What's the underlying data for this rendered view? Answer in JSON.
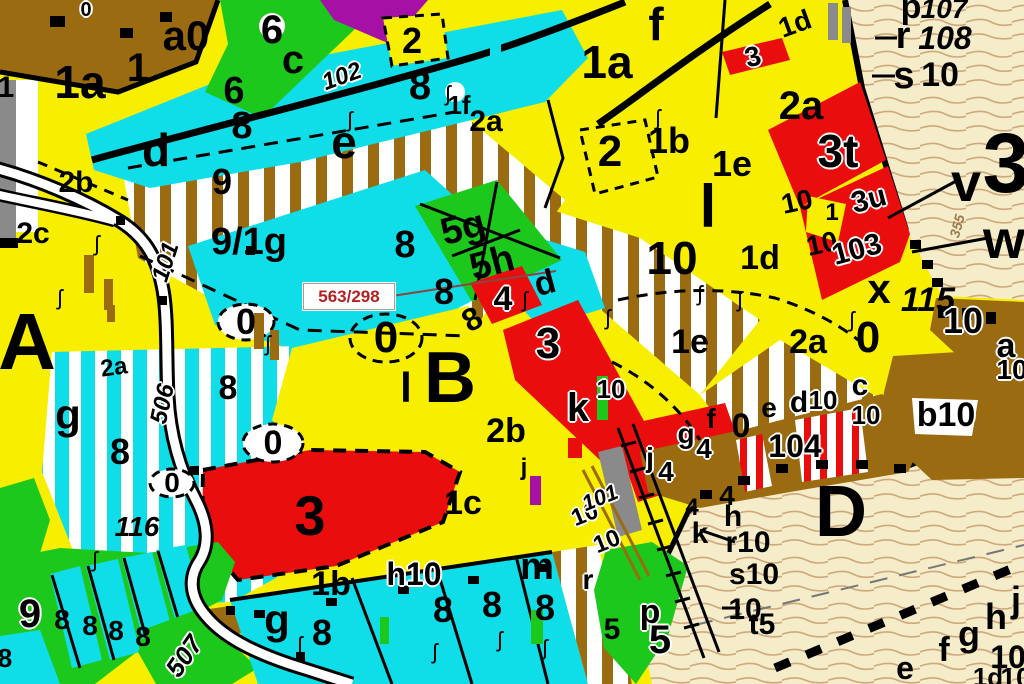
{
  "map": {
    "type": "forest-stand-cadastral-map",
    "annotation": {
      "text": "563/298",
      "color": "#b22222",
      "x": 303,
      "y": 283,
      "w": 90,
      "h": 25
    },
    "palette": {
      "yellow": "#f7ee00",
      "cyan": "#0fdde8",
      "green": "#1cc81c",
      "red": "#ea0d0d",
      "purple": "#a511a5",
      "brown": "#9a6b11",
      "beige": "#f5ecc9",
      "contour": "#cfa87c",
      "gray": "#8a8a8a",
      "white": "#ffffff",
      "black": "#000000",
      "road": "#ffffff",
      "annotation_red": "#b22222"
    },
    "labels": [
      {
        "t": "1a",
        "x": 80,
        "y": 82,
        "s": 46
      },
      {
        "t": "1",
        "x": 138,
        "y": 68,
        "s": 40
      },
      {
        "t": "a0",
        "x": 186,
        "y": 36,
        "s": 42
      },
      {
        "t": "0",
        "x": 86,
        "y": 10,
        "s": 20,
        "h": 1
      },
      {
        "t": "1",
        "x": 6,
        "y": 88,
        "s": 30
      },
      {
        "t": "6",
        "x": 272,
        "y": 30,
        "s": 40
      },
      {
        "t": "c",
        "x": 293,
        "y": 60,
        "s": 40
      },
      {
        "t": "6",
        "x": 234,
        "y": 91,
        "s": 38
      },
      {
        "t": "8",
        "x": 242,
        "y": 126,
        "s": 38
      },
      {
        "t": "d",
        "x": 156,
        "y": 150,
        "s": 46
      },
      {
        "t": "e",
        "x": 344,
        "y": 142,
        "s": 46
      },
      {
        "t": "102",
        "x": 342,
        "y": 77,
        "s": 24,
        "i": 1,
        "r": -20,
        "h": 1
      },
      {
        "t": "2",
        "x": 412,
        "y": 41,
        "s": 36
      },
      {
        "t": "8",
        "x": 420,
        "y": 86,
        "s": 40
      },
      {
        "t": "1f",
        "x": 459,
        "y": 105,
        "s": 26
      },
      {
        "t": "2a",
        "x": 486,
        "y": 122,
        "s": 30
      },
      {
        "t": "2b",
        "x": 76,
        "y": 183,
        "s": 30
      },
      {
        "t": "2c",
        "x": 33,
        "y": 234,
        "s": 30
      },
      {
        "t": "9",
        "x": 222,
        "y": 182,
        "s": 36
      },
      {
        "t": "9/1g",
        "x": 249,
        "y": 242,
        "s": 38
      },
      {
        "t": "101",
        "x": 166,
        "y": 262,
        "s": 24,
        "i": 1,
        "r": -72,
        "h": 1
      },
      {
        "t": "1a",
        "x": 607,
        "y": 62,
        "s": 46
      },
      {
        "t": "f",
        "x": 656,
        "y": 24,
        "s": 46
      },
      {
        "t": "2",
        "x": 610,
        "y": 152,
        "s": 44
      },
      {
        "t": "1b",
        "x": 669,
        "y": 141,
        "s": 36
      },
      {
        "t": "1e",
        "x": 732,
        "y": 164,
        "s": 36
      },
      {
        "t": "l",
        "x": 708,
        "y": 207,
        "s": 60
      },
      {
        "t": "1d",
        "x": 795,
        "y": 24,
        "s": 28,
        "r": -20
      },
      {
        "t": "3",
        "x": 753,
        "y": 57,
        "s": 28,
        "r": -15,
        "h": 1
      },
      {
        "t": "2a",
        "x": 801,
        "y": 106,
        "s": 40
      },
      {
        "t": "10",
        "x": 797,
        "y": 202,
        "s": 28,
        "r": -12
      },
      {
        "t": "10",
        "x": 822,
        "y": 244,
        "s": 28,
        "r": -12
      },
      {
        "t": "p",
        "x": 911,
        "y": 7,
        "s": 34
      },
      {
        "t": "107",
        "x": 944,
        "y": 9,
        "s": 28,
        "i": 1
      },
      {
        "t": "r",
        "x": 903,
        "y": 36,
        "s": 38
      },
      {
        "t": "108",
        "x": 945,
        "y": 38,
        "s": 32,
        "i": 1
      },
      {
        "t": "s",
        "x": 904,
        "y": 76,
        "s": 38
      },
      {
        "t": "10",
        "x": 940,
        "y": 75,
        "s": 34
      },
      {
        "t": "3t",
        "x": 838,
        "y": 151,
        "s": 46,
        "h": 1
      },
      {
        "t": "3u",
        "x": 869,
        "y": 200,
        "s": 30,
        "r": -15,
        "h": 1
      },
      {
        "t": "103",
        "x": 857,
        "y": 250,
        "s": 30,
        "r": -15,
        "h": 1
      },
      {
        "t": "1",
        "x": 832,
        "y": 213,
        "s": 24
      },
      {
        "t": "v",
        "x": 966,
        "y": 183,
        "s": 54
      },
      {
        "t": "3",
        "x": 1006,
        "y": 163,
        "s": 84
      },
      {
        "t": "w",
        "x": 1004,
        "y": 240,
        "s": 54
      },
      {
        "t": "x",
        "x": 879,
        "y": 289,
        "s": 42
      },
      {
        "t": "115",
        "x": 928,
        "y": 300,
        "s": 34,
        "i": 1
      },
      {
        "t": "355",
        "x": 957,
        "y": 226,
        "s": 14,
        "i": 1,
        "r": -75,
        "c": "#9b7d52"
      },
      {
        "t": "10",
        "x": 672,
        "y": 258,
        "s": 46
      },
      {
        "t": "1d",
        "x": 760,
        "y": 258,
        "s": 34
      },
      {
        "t": "1e",
        "x": 690,
        "y": 342,
        "s": 34
      },
      {
        "t": "2a",
        "x": 808,
        "y": 342,
        "s": 34
      },
      {
        "t": "k",
        "x": 578,
        "y": 408,
        "s": 40,
        "h": 1
      },
      {
        "t": "10",
        "x": 611,
        "y": 389,
        "s": 26,
        "h": 1
      },
      {
        "t": "0",
        "x": 246,
        "y": 322,
        "s": 36
      },
      {
        "t": "0",
        "x": 386,
        "y": 338,
        "s": 44
      },
      {
        "t": "8",
        "x": 405,
        "y": 245,
        "s": 38
      },
      {
        "t": "8",
        "x": 444,
        "y": 292,
        "s": 36
      },
      {
        "t": "8",
        "x": 472,
        "y": 319,
        "s": 32,
        "r": -30
      },
      {
        "t": "5g",
        "x": 463,
        "y": 228,
        "s": 38,
        "r": -15
      },
      {
        "t": "5h",
        "x": 492,
        "y": 263,
        "s": 38,
        "r": -15
      },
      {
        "t": "d",
        "x": 545,
        "y": 283,
        "s": 34,
        "r": -15
      },
      {
        "t": "4",
        "x": 503,
        "y": 299,
        "s": 34,
        "h": 1
      },
      {
        "t": "3",
        "x": 548,
        "y": 344,
        "s": 44,
        "h": 1
      },
      {
        "t": "B",
        "x": 450,
        "y": 378,
        "s": 72
      },
      {
        "t": "l",
        "x": 406,
        "y": 388,
        "s": 42
      },
      {
        "t": "2b",
        "x": 506,
        "y": 431,
        "s": 34
      },
      {
        "t": "j",
        "x": 524,
        "y": 468,
        "s": 24
      },
      {
        "t": "A",
        "x": 27,
        "y": 342,
        "s": 80
      },
      {
        "t": "g",
        "x": 68,
        "y": 415,
        "s": 42
      },
      {
        "t": "8",
        "x": 120,
        "y": 452,
        "s": 36
      },
      {
        "t": "2a",
        "x": 114,
        "y": 368,
        "s": 24,
        "r": -8
      },
      {
        "t": "8",
        "x": 228,
        "y": 388,
        "s": 34
      },
      {
        "t": "0",
        "x": 273,
        "y": 443,
        "s": 34
      },
      {
        "t": "0",
        "x": 172,
        "y": 483,
        "s": 28
      },
      {
        "t": "116",
        "x": 137,
        "y": 527,
        "s": 28,
        "i": 1
      },
      {
        "t": "506",
        "x": 163,
        "y": 404,
        "s": 24,
        "i": 1,
        "r": -78,
        "h": 1
      },
      {
        "t": "3",
        "x": 310,
        "y": 516,
        "s": 56
      },
      {
        "t": "1b",
        "x": 331,
        "y": 584,
        "s": 34
      },
      {
        "t": "1c",
        "x": 463,
        "y": 503,
        "s": 34
      },
      {
        "t": "h10",
        "x": 414,
        "y": 574,
        "s": 32,
        "h": 1
      },
      {
        "t": "9",
        "x": 30,
        "y": 614,
        "s": 40,
        "h": 1
      },
      {
        "t": "8",
        "x": 62,
        "y": 620,
        "s": 28
      },
      {
        "t": "8",
        "x": 90,
        "y": 626,
        "s": 28
      },
      {
        "t": "8",
        "x": 116,
        "y": 631,
        "s": 28
      },
      {
        "t": "8",
        "x": 143,
        "y": 637,
        "s": 28
      },
      {
        "t": "507",
        "x": 184,
        "y": 656,
        "s": 26,
        "i": 1,
        "r": -55,
        "h": 1
      },
      {
        "t": "8",
        "x": 5,
        "y": 658,
        "s": 26
      },
      {
        "t": "g",
        "x": 277,
        "y": 620,
        "s": 42
      },
      {
        "t": "8",
        "x": 322,
        "y": 633,
        "s": 36
      },
      {
        "t": "8",
        "x": 443,
        "y": 610,
        "s": 36
      },
      {
        "t": "8",
        "x": 492,
        "y": 605,
        "s": 36
      },
      {
        "t": "8",
        "x": 545,
        "y": 608,
        "s": 36
      },
      {
        "t": "m",
        "x": 537,
        "y": 567,
        "s": 38
      },
      {
        "t": "r",
        "x": 588,
        "y": 580,
        "s": 28,
        "h": 1
      },
      {
        "t": "p",
        "x": 650,
        "y": 612,
        "s": 34,
        "h": 1
      },
      {
        "t": "5",
        "x": 612,
        "y": 630,
        "s": 30
      },
      {
        "t": "5",
        "x": 660,
        "y": 640,
        "s": 40,
        "h": 1
      },
      {
        "t": "j",
        "x": 650,
        "y": 458,
        "s": 28,
        "h": 1
      },
      {
        "t": "4",
        "x": 666,
        "y": 472,
        "s": 28,
        "h": 1
      },
      {
        "t": "g",
        "x": 686,
        "y": 434,
        "s": 28,
        "h": 1
      },
      {
        "t": "4",
        "x": 704,
        "y": 449,
        "s": 28,
        "h": 1
      },
      {
        "t": "f",
        "x": 711,
        "y": 419,
        "s": 28
      },
      {
        "t": "0",
        "x": 741,
        "y": 426,
        "s": 34
      },
      {
        "t": "e",
        "x": 769,
        "y": 408,
        "s": 28
      },
      {
        "t": "d",
        "x": 799,
        "y": 403,
        "s": 30,
        "h": 1
      },
      {
        "t": "10",
        "x": 823,
        "y": 400,
        "s": 26,
        "h": 1
      },
      {
        "t": "c",
        "x": 860,
        "y": 386,
        "s": 30,
        "h": 1
      },
      {
        "t": "10",
        "x": 866,
        "y": 415,
        "s": 26,
        "h": 1
      },
      {
        "t": "104",
        "x": 795,
        "y": 446,
        "s": 32,
        "h": 1
      },
      {
        "t": "4",
        "x": 692,
        "y": 508,
        "s": 24
      },
      {
        "t": "k",
        "x": 700,
        "y": 534,
        "s": 30
      },
      {
        "t": "4",
        "x": 727,
        "y": 496,
        "s": 28
      },
      {
        "t": "h",
        "x": 733,
        "y": 517,
        "s": 30
      },
      {
        "t": "r10",
        "x": 748,
        "y": 543,
        "s": 30
      },
      {
        "t": "s10",
        "x": 754,
        "y": 575,
        "s": 30
      },
      {
        "t": "10",
        "x": 745,
        "y": 610,
        "s": 30
      },
      {
        "t": "t5",
        "x": 762,
        "y": 625,
        "s": 30
      },
      {
        "t": "D",
        "x": 841,
        "y": 512,
        "s": 72
      },
      {
        "t": "b10",
        "x": 946,
        "y": 415,
        "s": 34,
        "h": 1
      },
      {
        "t": "0",
        "x": 868,
        "y": 338,
        "s": 44
      },
      {
        "t": "10",
        "x": 963,
        "y": 321,
        "s": 36,
        "h": 1
      },
      {
        "t": "a",
        "x": 1006,
        "y": 346,
        "s": 34,
        "h": 1
      },
      {
        "t": "10",
        "x": 1012,
        "y": 370,
        "s": 28,
        "h": 1
      },
      {
        "t": "10",
        "x": 585,
        "y": 515,
        "s": 24,
        "r": -22,
        "h": 1
      },
      {
        "t": "10",
        "x": 607,
        "y": 542,
        "s": 24,
        "r": -22,
        "h": 1
      },
      {
        "t": "101",
        "x": 600,
        "y": 498,
        "s": 22,
        "i": 1,
        "r": -22,
        "h": 1
      },
      {
        "t": "e",
        "x": 905,
        "y": 668,
        "s": 32
      },
      {
        "t": "f",
        "x": 944,
        "y": 650,
        "s": 34
      },
      {
        "t": "g",
        "x": 969,
        "y": 634,
        "s": 36
      },
      {
        "t": "h",
        "x": 996,
        "y": 617,
        "s": 36
      },
      {
        "t": "j",
        "x": 1016,
        "y": 600,
        "s": 36
      },
      {
        "t": "10",
        "x": 1008,
        "y": 657,
        "s": 32
      },
      {
        "t": "1d",
        "x": 988,
        "y": 677,
        "s": 26
      },
      {
        "t": "10",
        "x": 1016,
        "y": 678,
        "s": 28
      }
    ],
    "symbols": [
      {
        "x": 97,
        "y": 244
      },
      {
        "x": 60,
        "y": 298
      },
      {
        "x": 350,
        "y": 120
      },
      {
        "x": 448,
        "y": 94
      },
      {
        "x": 268,
        "y": 344
      },
      {
        "x": 525,
        "y": 300
      },
      {
        "x": 608,
        "y": 318
      },
      {
        "x": 700,
        "y": 294
      },
      {
        "x": 545,
        "y": 648
      },
      {
        "x": 300,
        "y": 645
      },
      {
        "x": 435,
        "y": 652
      },
      {
        "x": 658,
        "y": 118
      },
      {
        "x": 852,
        "y": 320
      },
      {
        "x": 740,
        "y": 300
      },
      {
        "x": 95,
        "y": 560
      },
      {
        "x": 500,
        "y": 640
      }
    ]
  }
}
